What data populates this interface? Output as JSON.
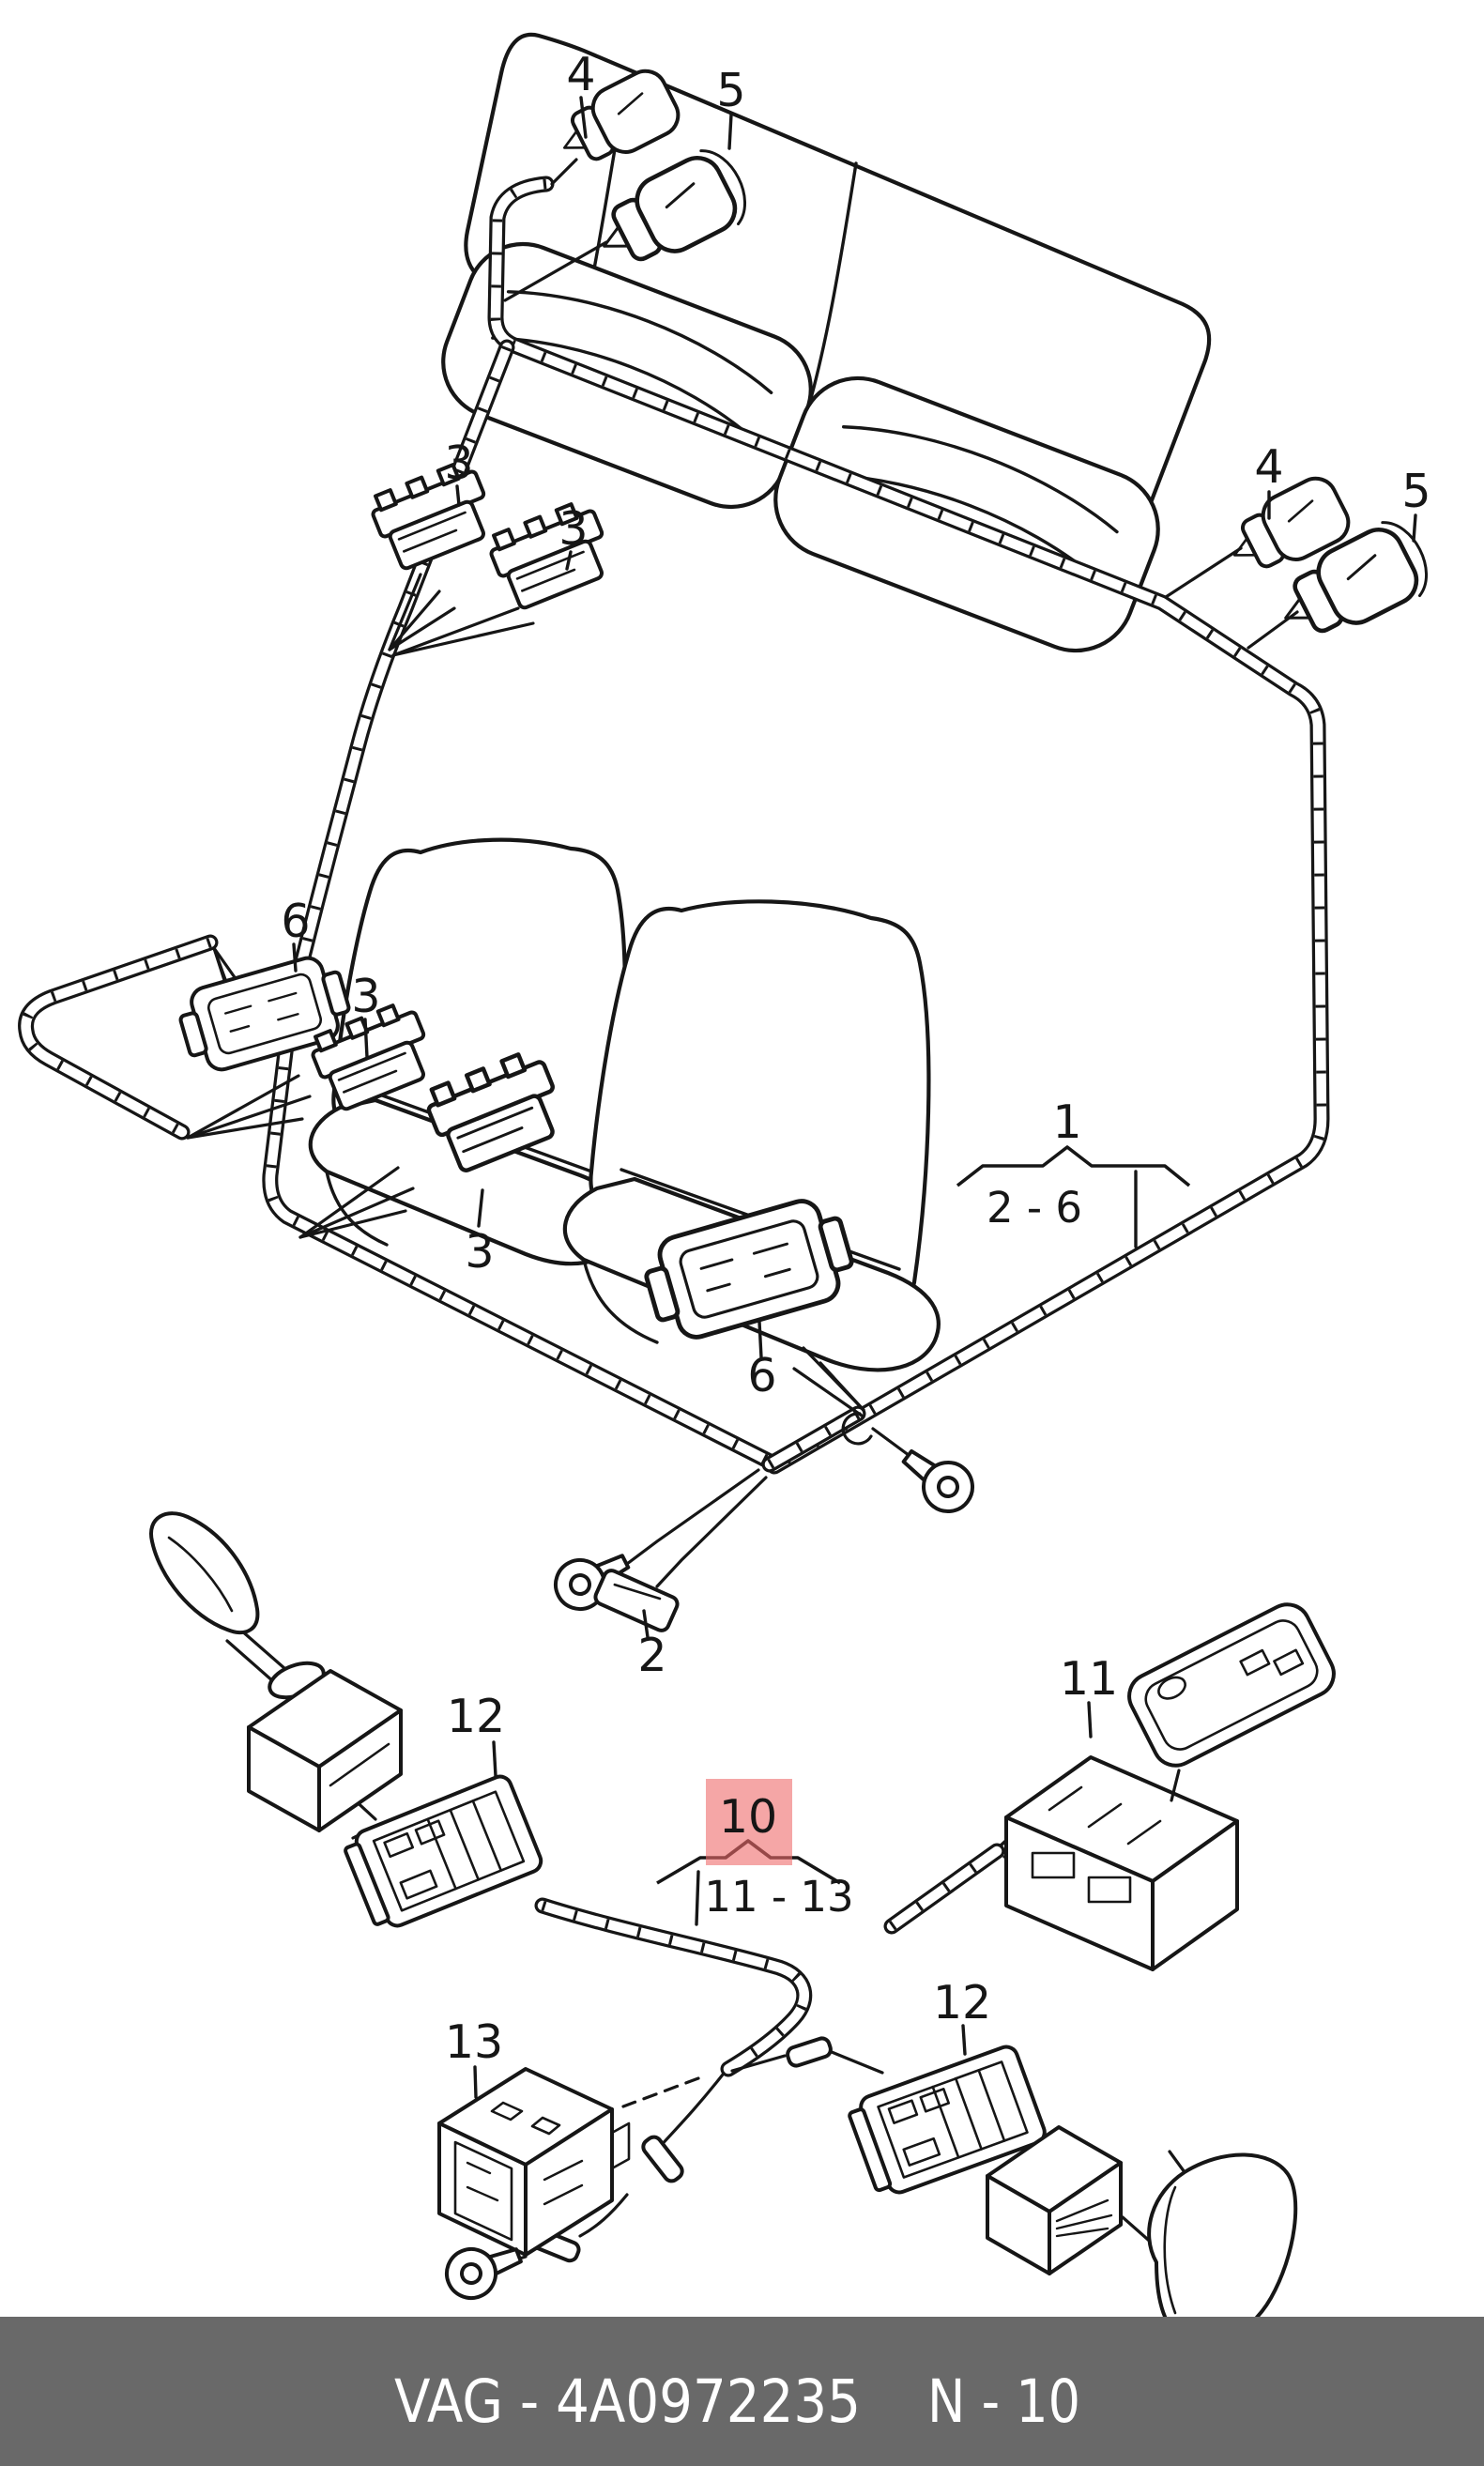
{
  "page": {
    "type": "parts-catalog-diagram",
    "background": "#ffffff"
  },
  "footer": {
    "part_code": "VAG - 4A0972235",
    "page_code": "N - 10",
    "bar_color": "#696969",
    "text_color": "#ffffff"
  },
  "highlight": {
    "color": "#ee6a6a",
    "label_color": "#8a1a1a"
  },
  "groups": {
    "seat_harness": {
      "callout": "1",
      "range": "2 - 6"
    },
    "mirror_harness": {
      "callout": "10",
      "range": "11 - 13"
    }
  },
  "callouts": {
    "grommet_top_4": "4",
    "grommet_top_5": "5",
    "connector_rear_3a": "3",
    "connector_rear_3b": "3",
    "grommet_right_4": "4",
    "grommet_right_5": "5",
    "connector_left_6": "6",
    "connector_mid_3c": "3",
    "connector_mid_3d": "3",
    "connector_seat_6": "6",
    "terminal_2": "2",
    "mirror_connector_12_left": "12",
    "switch_connector_11": "11",
    "connector_13": "13",
    "mirror_connector_12_right": "12"
  }
}
